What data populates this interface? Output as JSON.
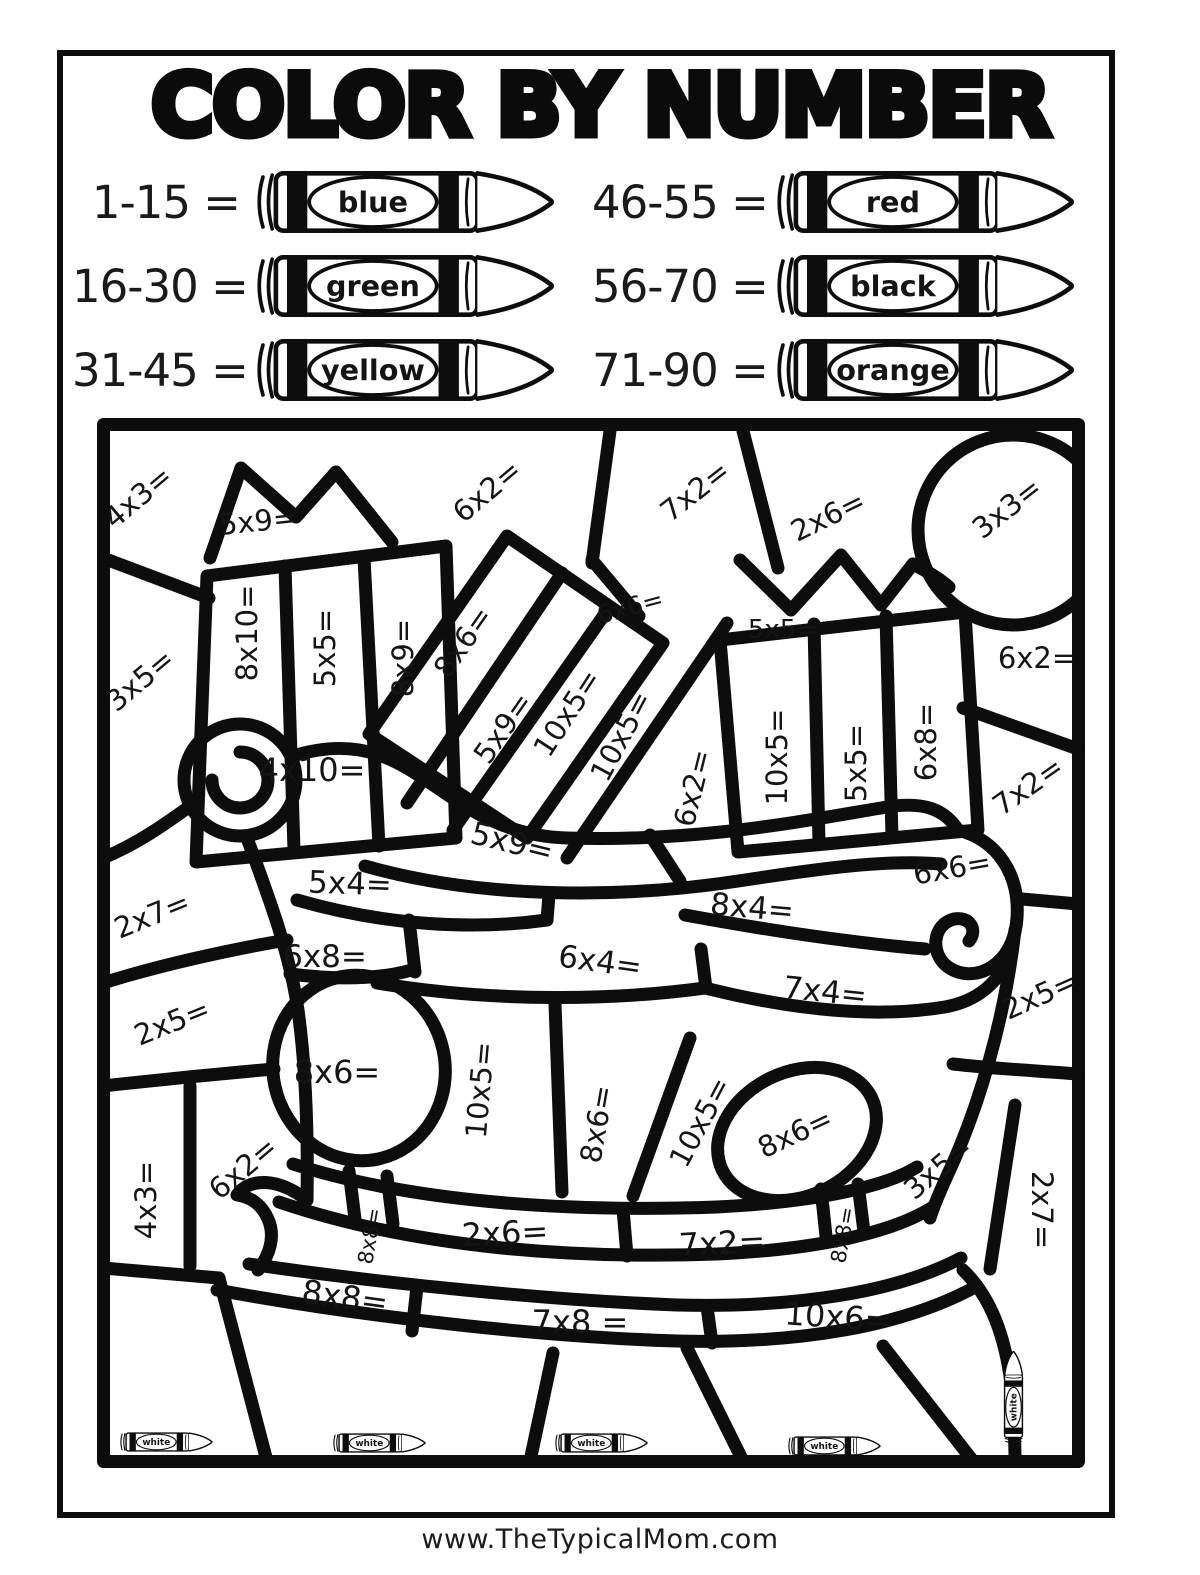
{
  "title": "COLOR BY NUMBER",
  "footer": {
    "website": "www.TheTypicalMom.com"
  },
  "colors": {
    "ink": "#0d0d0d"
  },
  "legend": [
    {
      "range": "1-15 =",
      "color": "blue"
    },
    {
      "range": "16-30 =",
      "color": "green"
    },
    {
      "range": "31-45 =",
      "color": "yellow"
    },
    {
      "range": "46-55 =",
      "color": "red"
    },
    {
      "range": "56-70 =",
      "color": "black"
    },
    {
      "range": "71-90 =",
      "color": "orange"
    }
  ],
  "puzzle": {
    "crayon_label": "white",
    "problems": [
      {
        "label": "4x3=",
        "x": 41,
        "y": 79,
        "rot": -40
      },
      {
        "label": "5x9=",
        "x": 161,
        "y": 103,
        "rot": -6
      },
      {
        "label": "6x2=",
        "x": 390,
        "y": 73,
        "rot": -40
      },
      {
        "label": "7x2=",
        "x": 598,
        "y": 73,
        "rot": -38
      },
      {
        "label": "2x6=",
        "x": 731,
        "y": 98,
        "rot": -26
      },
      {
        "label": "3x3=",
        "x": 910,
        "y": 90,
        "rot": -38
      },
      {
        "label": "3x5=",
        "x": 43,
        "y": 262,
        "rot": -40
      },
      {
        "label": "8x10=",
        "x": 150,
        "y": 215,
        "rot": -90
      },
      {
        "label": "5x5=",
        "x": 228,
        "y": 230,
        "rot": -90
      },
      {
        "label": "8x9=",
        "x": 306,
        "y": 240,
        "rot": -90
      },
      {
        "label": "8x6=",
        "x": 366,
        "y": 224,
        "rot": -55
      },
      {
        "label": "5x9=",
        "x": 406,
        "y": 310,
        "rot": -55
      },
      {
        "label": "10x5=",
        "x": 470,
        "y": 295,
        "rot": -57
      },
      {
        "label": "10x5=",
        "x": 524,
        "y": 318,
        "rot": -62
      },
      {
        "label": "6x2=",
        "x": 596,
        "y": 370,
        "rot": -76
      },
      {
        "label": "6x6=",
        "x": 533,
        "y": 189,
        "rot": -15,
        "size": 25
      },
      {
        "label": "5x5=",
        "x": 686,
        "y": 212,
        "rot": 0,
        "size": 26
      },
      {
        "label": "10x5=",
        "x": 680,
        "y": 339,
        "rot": -90
      },
      {
        "label": "5x5=",
        "x": 759,
        "y": 345,
        "rot": -90
      },
      {
        "label": "6x8=",
        "x": 829,
        "y": 324,
        "rot": -90
      },
      {
        "label": "6x2=",
        "x": 940,
        "y": 240,
        "rot": 0
      },
      {
        "label": "7x2=",
        "x": 931,
        "y": 368,
        "rot": -35
      },
      {
        "label": "4x10=",
        "x": 215,
        "y": 352,
        "rot": 0,
        "size": 32
      },
      {
        "label": "5x9=",
        "x": 415,
        "y": 425,
        "rot": 14,
        "size": 31
      },
      {
        "label": "5x4=",
        "x": 253,
        "y": 466,
        "rot": 2,
        "size": 31
      },
      {
        "label": "8x4=",
        "x": 655,
        "y": 490,
        "rot": 5,
        "size": 31
      },
      {
        "label": "6x6=",
        "x": 855,
        "y": 450,
        "rot": -10
      },
      {
        "label": "2x7=",
        "x": 55,
        "y": 497,
        "rot": -22
      },
      {
        "label": "6x8=",
        "x": 228,
        "y": 539,
        "rot": 0,
        "size": 31
      },
      {
        "label": "6x4=",
        "x": 503,
        "y": 544,
        "rot": 8,
        "size": 31
      },
      {
        "label": "7x4=",
        "x": 728,
        "y": 574,
        "rot": 6,
        "size": 31
      },
      {
        "label": "2x5=",
        "x": 75,
        "y": 604,
        "rot": -22
      },
      {
        "label": "2x5=",
        "x": 943,
        "y": 577,
        "rot": -24
      },
      {
        "label": "8x6=",
        "x": 240,
        "y": 654,
        "rot": 0,
        "size": 32
      },
      {
        "label": "10x5=",
        "x": 383,
        "y": 672,
        "rot": -85
      },
      {
        "label": "8x6=",
        "x": 500,
        "y": 706,
        "rot": -80
      },
      {
        "label": "10x5=",
        "x": 603,
        "y": 704,
        "rot": -62
      },
      {
        "label": "8x6=",
        "x": 698,
        "y": 715,
        "rot": -25
      },
      {
        "label": "4x3=",
        "x": 49,
        "y": 782,
        "rot": -90
      },
      {
        "label": "6x2=",
        "x": 146,
        "y": 750,
        "rot": -40
      },
      {
        "label": "3x5=",
        "x": 841,
        "y": 750,
        "rot": -40
      },
      {
        "label": "2x7=",
        "x": 945,
        "y": 792,
        "rot": 90
      },
      {
        "label": "8x8=",
        "x": 273,
        "y": 818,
        "rot": -80,
        "size": 21
      },
      {
        "label": "2x6=",
        "x": 408,
        "y": 815,
        "rot": -3,
        "size": 32
      },
      {
        "label": "7x2=",
        "x": 625,
        "y": 825,
        "rot": -3,
        "size": 32
      },
      {
        "label": "8x8=",
        "x": 746,
        "y": 817,
        "rot": -80,
        "size": 21
      },
      {
        "label": "8x8=",
        "x": 248,
        "y": 879,
        "rot": 8,
        "size": 32
      },
      {
        "label": "7x8 =",
        "x": 483,
        "y": 904,
        "rot": 0,
        "size": 32
      },
      {
        "label": "10x6=",
        "x": 741,
        "y": 899,
        "rot": 4,
        "size": 32
      }
    ],
    "white_crayons": [
      {
        "x": 68,
        "y": 1024,
        "rot": 0
      },
      {
        "x": 281,
        "y": 1025,
        "rot": 0
      },
      {
        "x": 503,
        "y": 1025,
        "rot": 0
      },
      {
        "x": 736,
        "y": 1028,
        "rot": 0
      },
      {
        "x": 916,
        "y": 980,
        "rot": -90
      }
    ]
  }
}
